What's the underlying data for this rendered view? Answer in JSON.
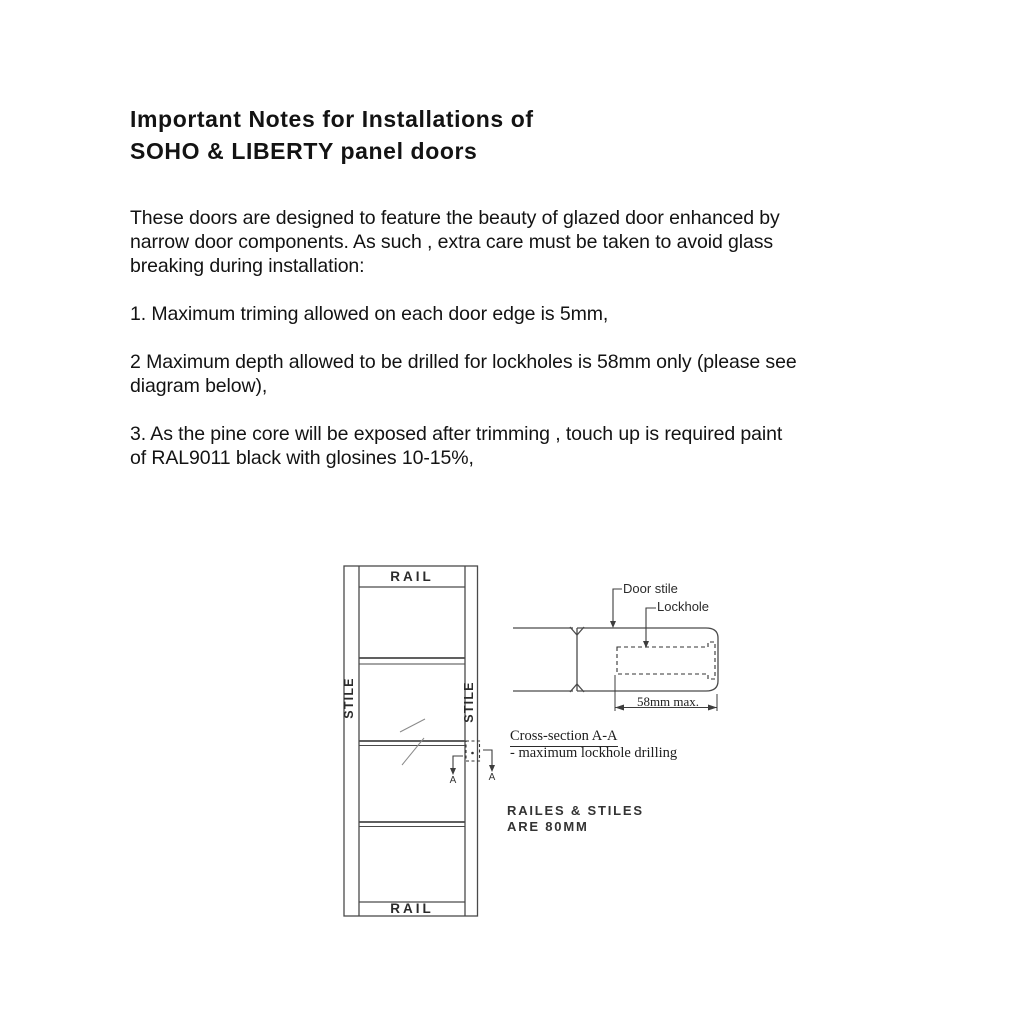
{
  "document": {
    "title": [
      "Important Notes for Installations of",
      "SOHO & LIBERTY panel doors"
    ],
    "intro": [
      "These doors are designed to feature the beauty of glazed door enhanced by",
      "narrow door components. As such , extra care must be taken to avoid glass",
      "breaking during installation:"
    ],
    "note1": [
      "1. Maximum triming allowed on each door edge is 5mm,"
    ],
    "note2": [
      "2 Maximum depth allowed to be drilled for lockholes is 58mm only (please see",
      "diagram below),"
    ],
    "note3": [
      "3. As the pine core will be exposed after trimming , touch up is required paint",
      "of RAL9011 black with glosines 10-15%,"
    ]
  },
  "diagram": {
    "door_elevation": {
      "rail_top_label": "RAIL",
      "rail_bottom_label": "RAIL",
      "stile_left_label": "STILE",
      "stile_right_label": "STILE",
      "section_marker_label": "A"
    },
    "cross_section": {
      "door_stile_label": "Door stile",
      "lockhole_label": "Lockhole",
      "dimension_label": "58mm max.",
      "caption_title": "Cross-section A-A",
      "caption_subtitle": "- maximum lockhole drilling"
    },
    "size_note": [
      "RAILES & STILES",
      "ARE 80MM"
    ]
  },
  "colors": {
    "ink": "#131313",
    "drawing_line": "#4a4a4a",
    "background": "#ffffff"
  }
}
